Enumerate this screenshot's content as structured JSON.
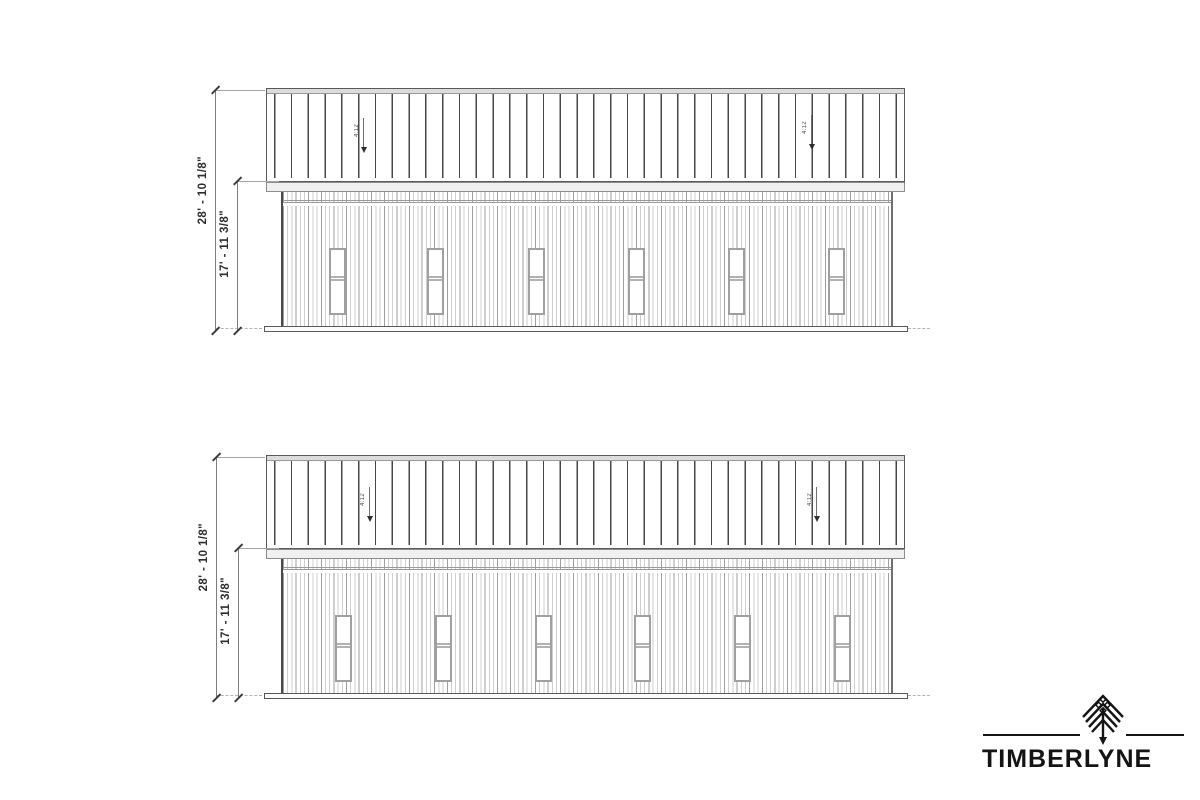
{
  "sheet": {
    "background": "#ffffff",
    "line_color_dark": "#474747",
    "line_color_light": "#cfcfcf"
  },
  "elevations": [
    {
      "overall_height": "28' - 10 1/8\"",
      "wall_height": "17' - 11 3/8\"",
      "slope_left": "4:12",
      "slope_right": "4:12",
      "window_count": 6
    },
    {
      "overall_height": "28' - 10 1/8\"",
      "wall_height": "17' - 11 3/8\"",
      "slope_left": "4:12",
      "slope_right": "4:12",
      "window_count": 6
    }
  ],
  "logo": {
    "wordmark": "TIMBERLYNE",
    "icon": "pine-tree",
    "color": "#141414"
  }
}
